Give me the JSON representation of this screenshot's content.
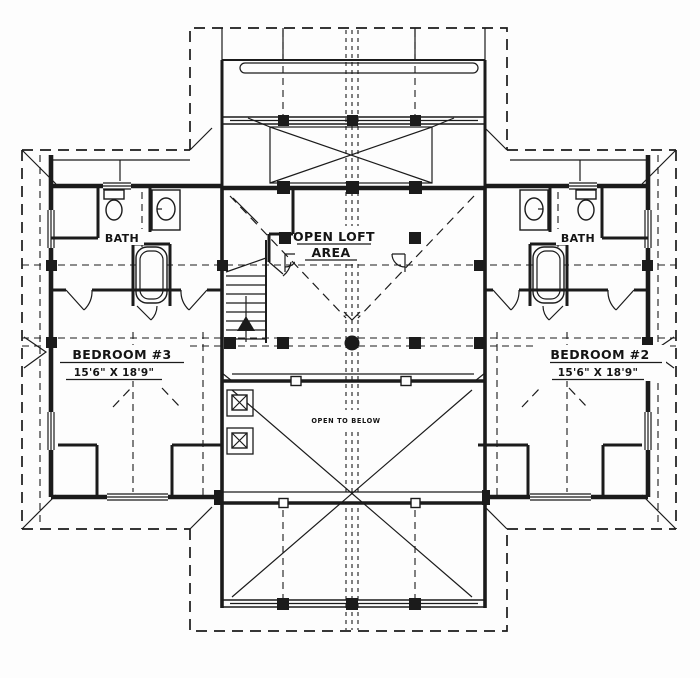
{
  "plan": {
    "title": "Second floor / loft level floor plan",
    "labels": {
      "open_loft": {
        "line1": "OPEN LOFT",
        "line2": "AREA"
      },
      "bath_left": "BATH",
      "bath_right": "BATH",
      "bedroom3": {
        "name": "BEDROOM #3",
        "dims": "15'6\" X 18'9\""
      },
      "bedroom2": {
        "name": "BEDROOM #2",
        "dims": "15'6\" X 18'9\""
      },
      "open_to_below": "OPEN TO BELOW"
    },
    "colors": {
      "ink": "#1b1b1b",
      "paper": "#fdfdfd"
    }
  }
}
